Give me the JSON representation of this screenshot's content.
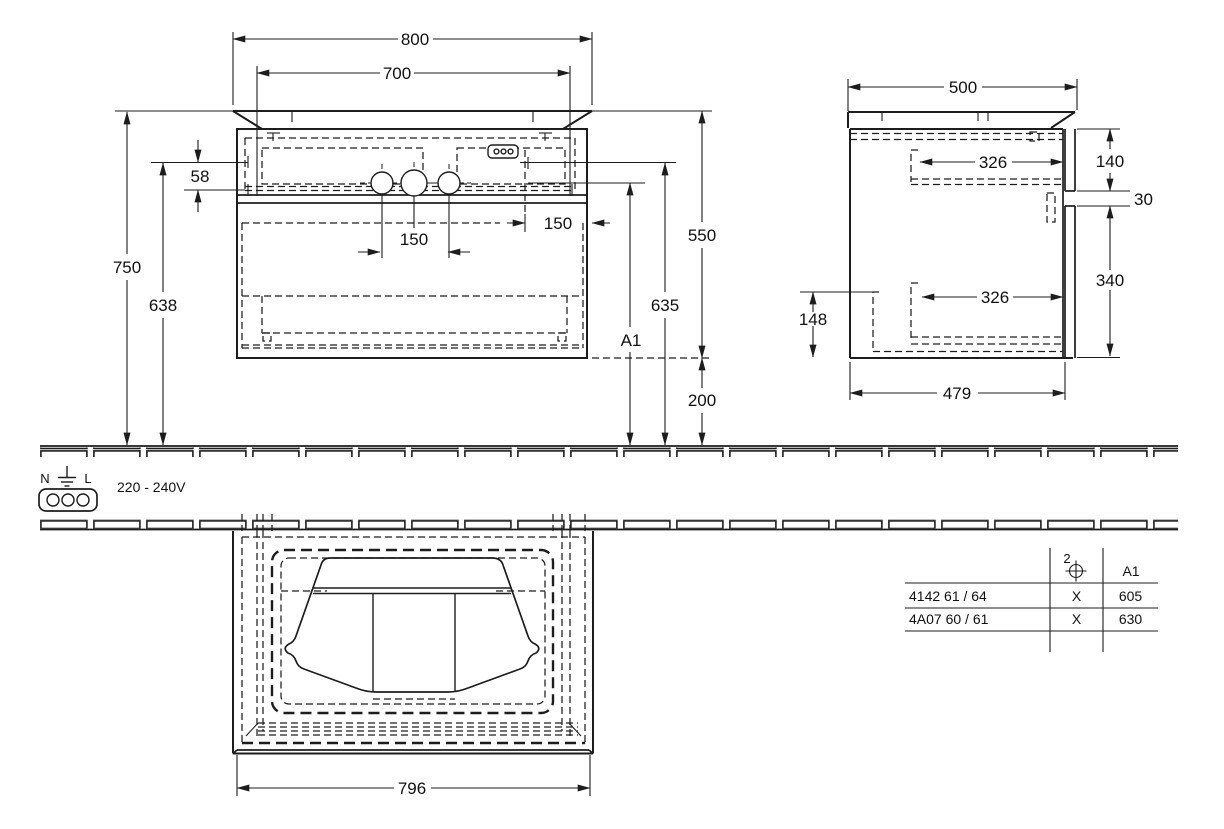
{
  "front_view": {
    "dims": {
      "width_total": "800",
      "width_fixing": "700",
      "rail_offset": "58",
      "height_floor_to_top": "750",
      "height_fixing_left": "638",
      "hole_spacing_left": "150",
      "hole_spacing_right": "150",
      "cabinet_height": "550",
      "height_fixing_right": "635",
      "height_variable": "A1",
      "bottom_clearance": "200"
    }
  },
  "side_view": {
    "dims": {
      "depth_total": "500",
      "drawer_top_depth": "326",
      "drawer_bottom_depth": "326",
      "front_top_height": "140",
      "gap_height": "30",
      "front_bottom_height": "340",
      "rear_recess_height": "148",
      "cabinet_depth": "479"
    }
  },
  "plan_view": {
    "dims": {
      "cabinet_width": "796"
    }
  },
  "electrical": {
    "neutral": "N",
    "line": "L",
    "voltage": "220 - 240V"
  },
  "spec_table": {
    "qty": "2",
    "dim_label": "A1",
    "rows": [
      {
        "model": "4142 61 / 64",
        "mark": "X",
        "value": "605"
      },
      {
        "model": "4A07 60 / 61",
        "mark": "X",
        "value": "630"
      }
    ]
  }
}
